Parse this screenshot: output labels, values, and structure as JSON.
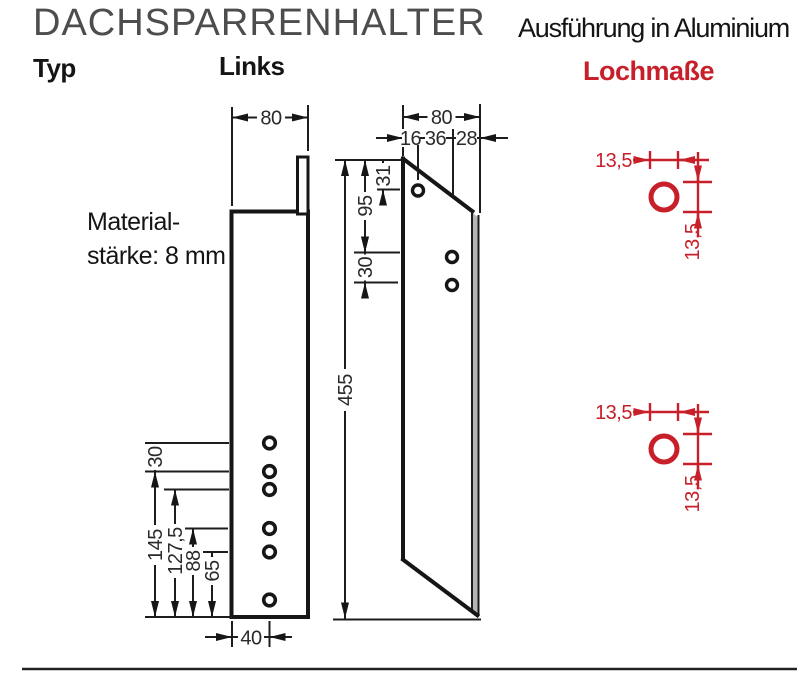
{
  "header": {
    "title": "DACHSPARRENHALTER",
    "subtitle": "Ausführung in Aluminium",
    "type_label": "Typ",
    "variant_label": "Links",
    "holes_label": "Lochmaße"
  },
  "material_note": {
    "line1": "Material-",
    "line2": "stärke: 8 mm"
  },
  "front_view": {
    "width": "80",
    "hole_offset": "40",
    "top_spacing": "30",
    "d145": "145",
    "d127_5": "127,5",
    "d88": "88",
    "d65": "65"
  },
  "side_view": {
    "width": "80",
    "seg16": "16",
    "seg36": "36",
    "seg28": "28",
    "d31": "31",
    "d95": "95",
    "d30": "30",
    "height": "455"
  },
  "hole_detail": {
    "diameter": "13,5"
  },
  "colors": {
    "line": "#1d1d1d",
    "red": "#c8202a",
    "title_gray": "#4d4d4d"
  }
}
